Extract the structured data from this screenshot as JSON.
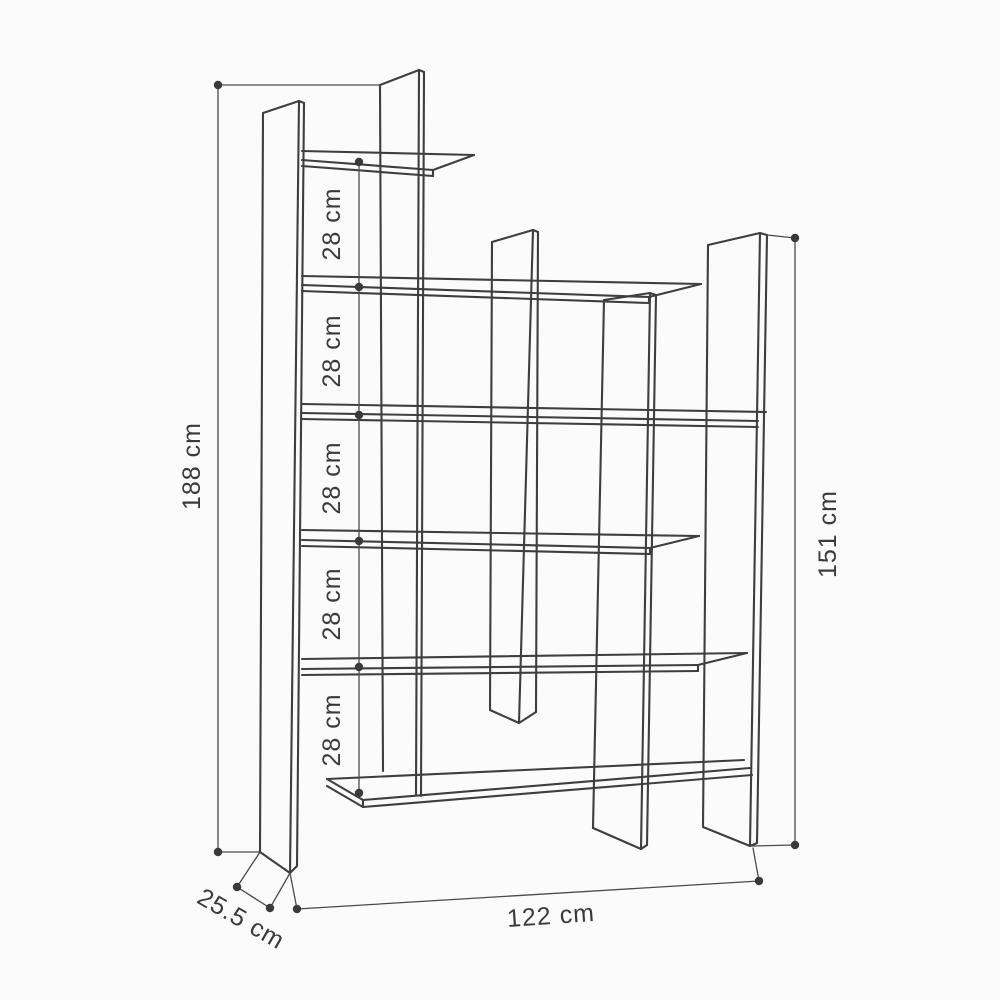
{
  "diagram": {
    "type": "furniture-dimension-drawing",
    "subject": "Staggered open bookcase technical drawing",
    "units": "cm",
    "dimensions": {
      "total_height": "188 cm",
      "gaps": [
        "28 cm",
        "28 cm",
        "28 cm",
        "28 cm",
        "28 cm"
      ],
      "right_panel_height": "151 cm",
      "width": "122 cm",
      "depth": "25.5 cm"
    },
    "colors": {
      "line": "#3e3e3e",
      "dimension_line": "#4a4a4a",
      "text": "#3a3a3a",
      "background": "#fbfbfb"
    }
  }
}
